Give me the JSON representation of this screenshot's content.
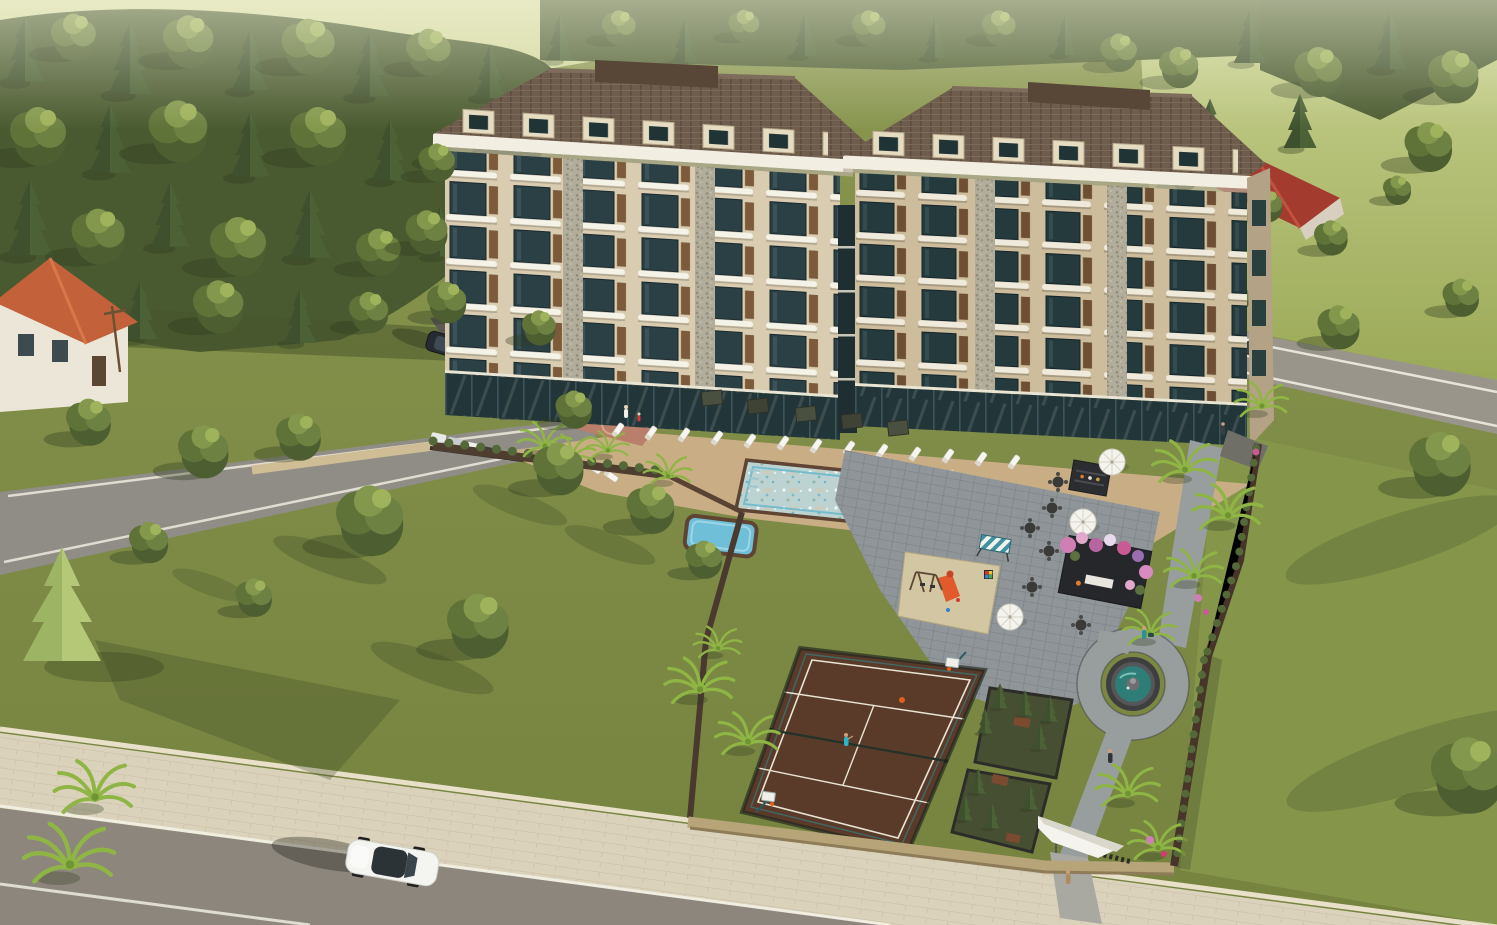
{
  "scene": {
    "description": "Aerial 3D architectural rendering of a gated twin-building residential complex with landscaped gardens, swimming pool, sport court, fountain and surrounding streets",
    "view": "high-angle aerial, daytime",
    "visible_text": "none"
  },
  "palette": {
    "grass": "#7f8c49",
    "lawn_shadow": "#46542a",
    "distant_field": "#d8dda6",
    "forest": "#4a5a30",
    "road_asphalt": "#8d867d",
    "sidewalk": "#dbd2bc",
    "building_facade": "#d9ccb0",
    "building_facade_shaded": "#cdbd9c",
    "window_glass": "#2b4044",
    "balcony_rail": "#f5f2e7",
    "stone_pier": "#b2ac9b",
    "roof_tile": "#6e5c4d",
    "cornice": "#f2eee1",
    "pool_water": "#bcd3d2",
    "pool_coping": "#5f4433",
    "court_surface": "#5a3b2a",
    "court_lines": "#e9e4d4",
    "path_pavers": "#989e9e",
    "boundary_wall": "#463528",
    "retaining_wall": "#cfbd96",
    "palm_frond": "#8fb544",
    "flower_pink": "#cf7fb4",
    "fountain_water": "#2e7d76",
    "entrance_canopy": "#f4f3ee",
    "car_white": "#f4f4f1",
    "suv_dark": "#262b31"
  },
  "complex": {
    "buildings": [
      {
        "id": "left-block",
        "window_floors": 5,
        "window_bays": 6,
        "roof": "hipped brown tile with cream dormers",
        "facade": "cream with stone piers, dark green glass and white curved balconies",
        "rooftop": "utility box"
      },
      {
        "id": "right-block",
        "window_floors": 5,
        "window_bays": 6,
        "roof": "hipped brown tile with cream dormers",
        "facade": "cream with stone piers, dark green glass and white curved balconies",
        "rooftop": "utility box"
      }
    ],
    "amenities": [
      "swimming pool with in-pool loungers",
      "kids pool",
      "sun deck with loungers",
      "dark patio umbrellas",
      "white umbrellas",
      "seating plaza with round tables",
      "outdoor bar unit",
      "flower-covered pergola",
      "striped canopy swing",
      "children playground with orange slide and swings",
      "multi-sport tennis and basketball court",
      "round garden fountain",
      "hedged seating nooks with tables",
      "white angular entrance canopy",
      "perimeter walls",
      "palm-lined paths"
    ],
    "counts": {
      "sun_loungers": 17,
      "in_pool_loungers": 3,
      "white_umbrellas": 3,
      "dark_umbrellas": 5,
      "plaza_tables": 6,
      "garden_tables": 3,
      "palm_trees": 16,
      "basketball_hoops": 2,
      "dormers_per_roof": 6
    }
  },
  "surroundings": {
    "roads": [
      "front street with beige sidewalk and white lane lines",
      "upper-left side street",
      "right street",
      "driveway ramp with parking strip"
    ],
    "vehicles": [
      {
        "type": "sedan",
        "color": "white",
        "location": "front street, heading right"
      },
      {
        "type": "suv",
        "color": "dark gray",
        "location": "driveway ramp"
      },
      {
        "type": "parked cars",
        "count": 5,
        "location": "parking strip by left building"
      },
      {
        "type": "car",
        "color": "white",
        "location": "right street"
      }
    ],
    "neighbors": [
      "white house with orange tile roof (left edge)",
      "red gabled roof house (upper right)",
      "dense pine and deciduous forest (top)",
      "pale hazy meadow (horizon)",
      "large cedar tree (lower left lawn)"
    ]
  },
  "people": [
    {
      "where": "pool-side plaza",
      "detail": "adult with child in red"
    },
    {
      "where": "sport court",
      "detail": "tennis player in blue"
    },
    {
      "where": "garden path",
      "detail": "walker in dark coat"
    },
    {
      "where": "entrance gate sidewalk",
      "detail": "pedestrian in tan"
    },
    {
      "where": "path right of right building",
      "detail": "pedestrian"
    },
    {
      "where": "fountain walkway",
      "detail": "person with stroller"
    }
  ]
}
